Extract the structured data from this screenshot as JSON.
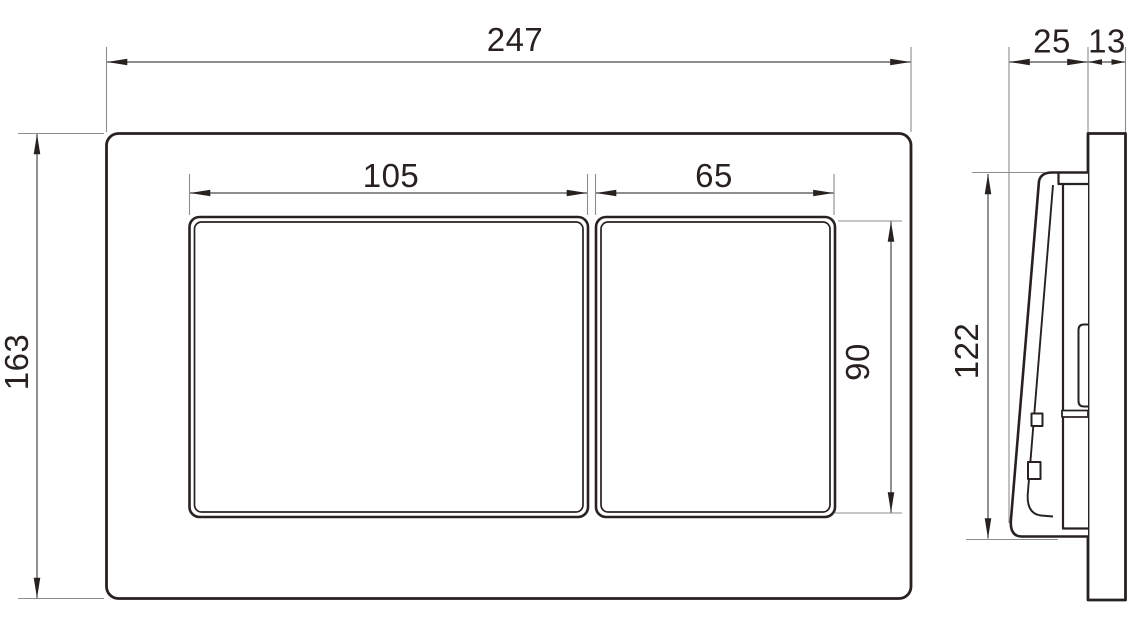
{
  "drawing_type": "technical-dimension-drawing",
  "views": {
    "front": "front-view-flush-plate",
    "side": "side-profile-view"
  },
  "dimensions": {
    "front": {
      "overall_width": "247",
      "overall_height": "163",
      "left_button_width": "105",
      "right_button_width": "65",
      "button_height": "90"
    },
    "side": {
      "button_depth": "25",
      "frame_depth": "13",
      "button_height": "122"
    }
  },
  "colors": {
    "outline": "#272220",
    "dimension_line": "#4a4a4a",
    "extension_line": "#8d8d8d",
    "arrow": "#272220",
    "label": "#272220",
    "background": "#ffffff"
  }
}
